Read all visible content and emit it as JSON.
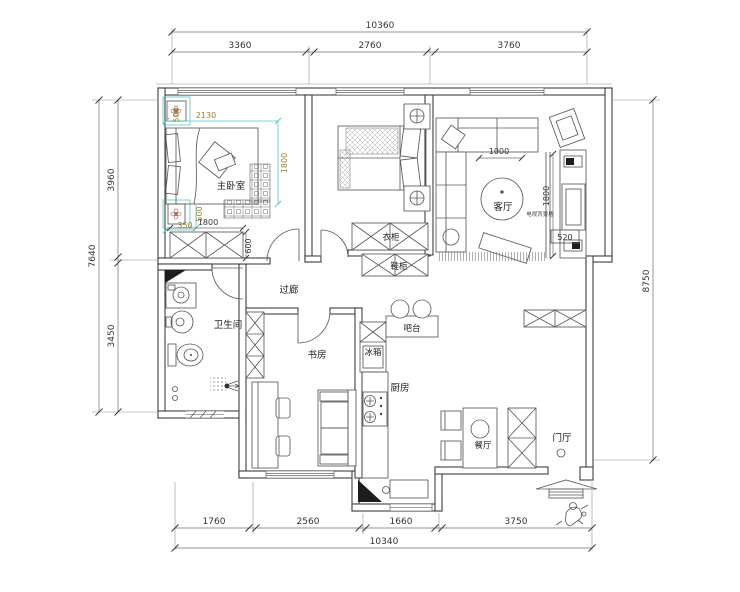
{
  "drawing": {
    "type": "apartment-floor-plan"
  },
  "rooms": {
    "master_bedroom": "主卧室",
    "wardrobe": "衣柜",
    "shoe_cabinet": "鞋柜",
    "living_room": "客厅",
    "tv_wall": "电视背景墙",
    "bathroom": "卫生间",
    "corridor": "过廊",
    "study": "书房",
    "bar": "吧台",
    "fridge": "冰箱",
    "kitchen": "厨房",
    "dining_room": "餐厅",
    "foyer": "门厅"
  },
  "dims": {
    "top": {
      "total": "10360",
      "s": [
        "3360",
        "2760",
        "3760"
      ]
    },
    "bottom": {
      "total": "10340",
      "s": [
        "1760",
        "2560",
        "1660",
        "3750"
      ]
    },
    "left": {
      "total": "7640",
      "s": [
        "3960",
        "3450"
      ]
    },
    "right": {
      "total": "8750"
    },
    "master": {
      "width": "2130",
      "depth": "1800",
      "nightstand_a": "500",
      "nightstand_b": "500",
      "rug": "350",
      "wardrobe_w": "1800",
      "wardrobe_d": "600"
    },
    "living": {
      "rug": "1000",
      "tv": "1800",
      "cabinet": "520"
    }
  },
  "colors": {
    "wall": "#3f3f3f",
    "dim_line": "#6e6e6e",
    "accent_cyan": "#5ec1c1",
    "accent_olive": "#9c8030",
    "flower": "#a3766a"
  }
}
